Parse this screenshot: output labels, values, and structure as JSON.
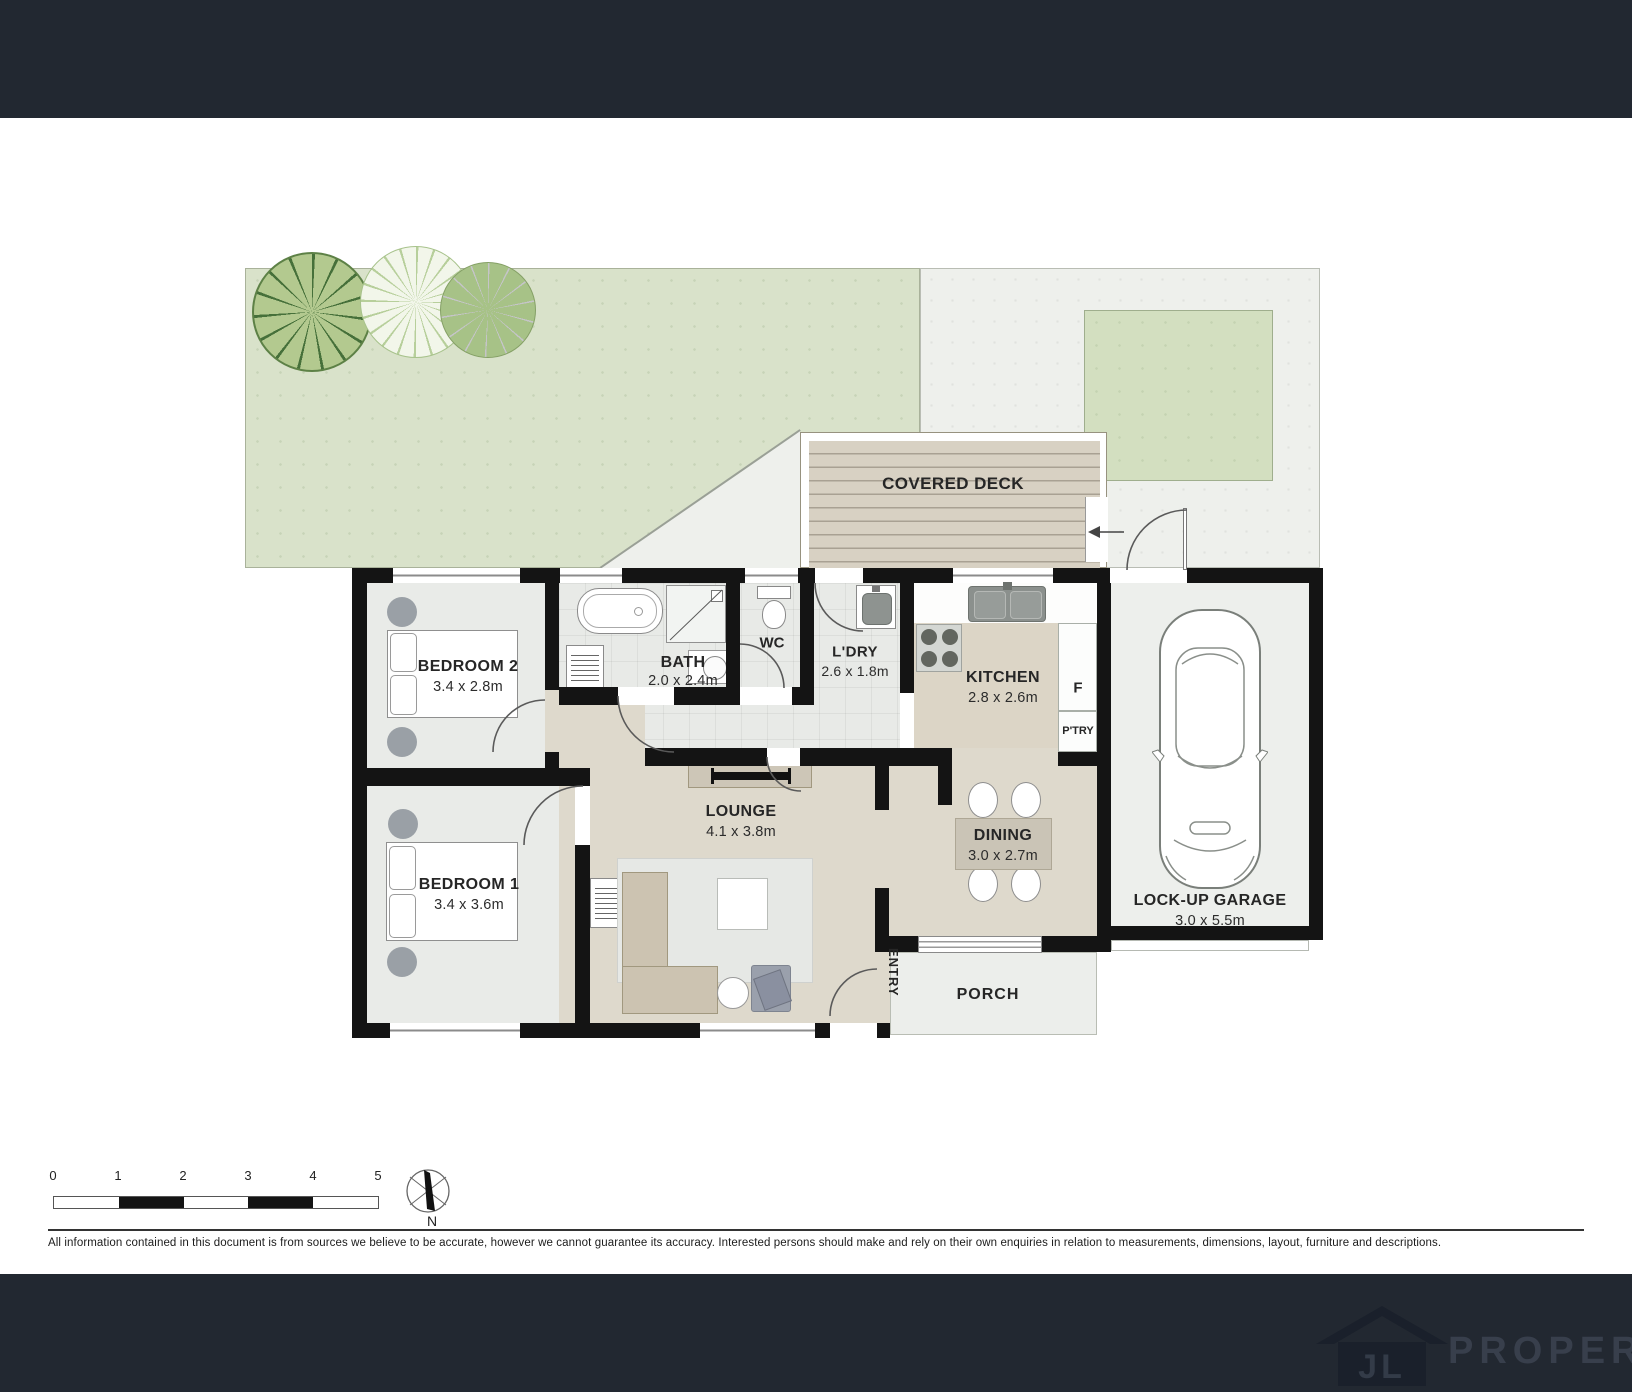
{
  "page": {
    "type": "real-estate floor plan"
  },
  "floor_plan": {
    "outdoor": {
      "covered_deck": "COVERED DECK"
    },
    "rooms": {
      "bedroom_2": {
        "name": "BEDROOM 2",
        "dimensions": "3.4 x 2.8m"
      },
      "bedroom_1": {
        "name": "BEDROOM 1",
        "dimensions": "3.4 x 3.6m"
      },
      "bath": {
        "name": "BATH",
        "dimensions": "2.0 x 2.4m"
      },
      "wc": {
        "name": "WC"
      },
      "laundry": {
        "name": "L'DRY",
        "dimensions": "2.6 x 1.8m"
      },
      "kitchen": {
        "name": "KITCHEN",
        "dimensions": "2.8 x 2.6m"
      },
      "fridge": {
        "name": "F"
      },
      "pantry": {
        "name": "P'TRY"
      },
      "lounge": {
        "name": "LOUNGE",
        "dimensions": "4.1 x 3.8m"
      },
      "dining": {
        "name": "DINING",
        "dimensions": "3.0 x 2.7m"
      },
      "garage": {
        "name": "LOCK-UP GARAGE",
        "dimensions": "3.0 x 5.5m"
      },
      "porch": {
        "name": "PORCH"
      },
      "entry": {
        "name": "ENTRY"
      }
    }
  },
  "scale_bar": {
    "labels": [
      "0",
      "1",
      "2",
      "3",
      "4",
      "5"
    ]
  },
  "compass": {
    "north_label": "N"
  },
  "disclaimer": "All information contained in this document is from sources we believe to be accurate, however we cannot guarantee its accuracy. Interested persons should make and rely on their own enquiries in relation to measurements, dimensions, layout, furniture and descriptions.",
  "footer": {
    "logo_initials": "JL",
    "logo_name": "PROPERTY"
  },
  "colors": {
    "header_bar": "#222831",
    "garden_green": "#d9e2ca",
    "lawn_green": "#d3dfc0",
    "yard_grey": "#eef0ec",
    "deck_tan": "#d7d0c2",
    "floor_beige": "#ded9cc",
    "floor_grey": "#e9ebe8",
    "wall_black": "#141414"
  }
}
